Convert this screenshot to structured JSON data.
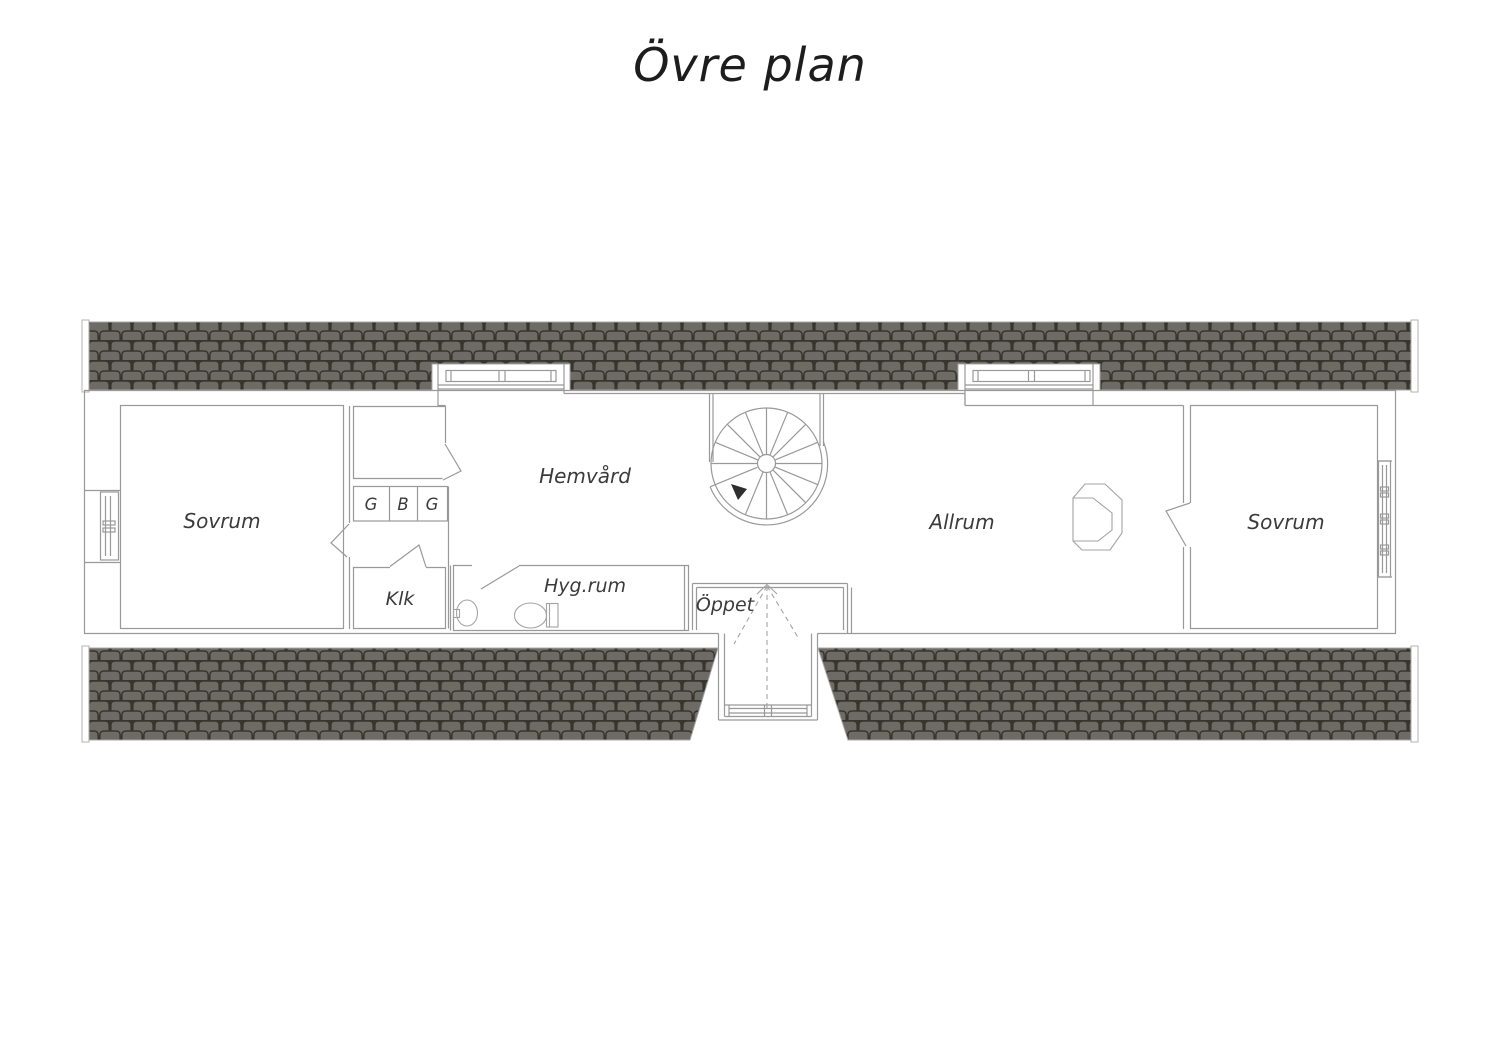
{
  "title": "Övre plan",
  "floorplan": {
    "rooms": {
      "bedroom_left": {
        "label": "Sovrum"
      },
      "homecare": {
        "label": "Hemvård"
      },
      "walk_in_closet": {
        "label": "Klk"
      },
      "hygiene": {
        "label": "Hyg.rum"
      },
      "open_to_below": {
        "label": "Öppet"
      },
      "living": {
        "label": "Allrum"
      },
      "bedroom_right": {
        "label": "Sovrum"
      }
    },
    "wardrobes": [
      {
        "label": "G"
      },
      {
        "label": "B"
      },
      {
        "label": "G"
      }
    ]
  },
  "colors": {
    "roof_tile": "#6e6a65",
    "roof_seam": "#38352f",
    "wall_line": "#999999",
    "label_text": "#3b3b3b",
    "title_text": "#1d1d1d",
    "background": "#ffffff"
  }
}
